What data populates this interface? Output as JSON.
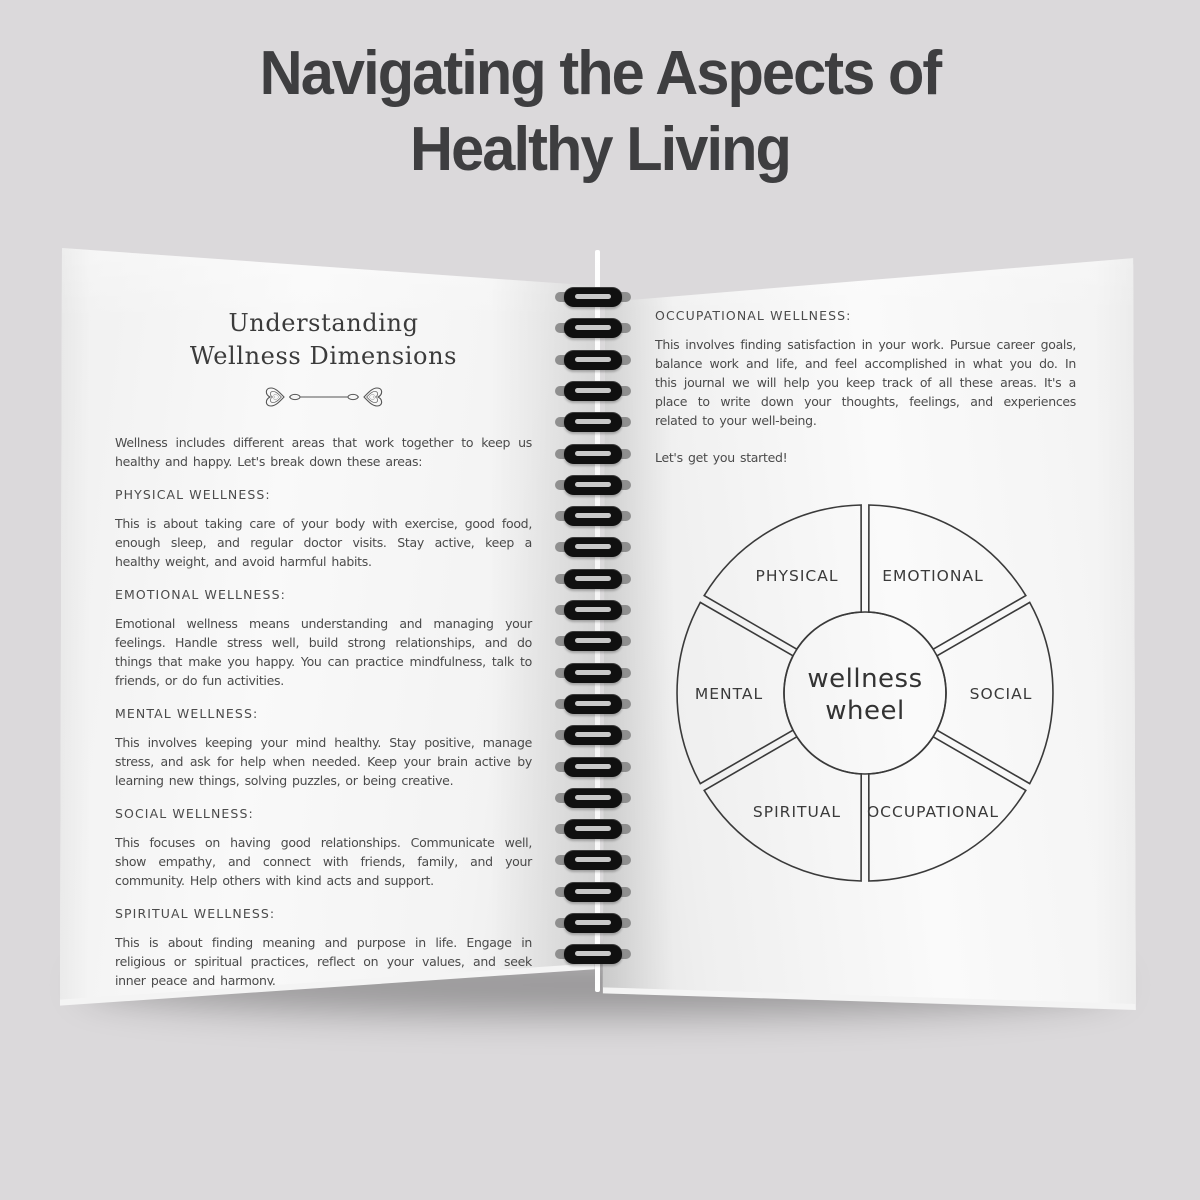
{
  "title": {
    "line1": "Navigating the Aspects of",
    "line2": "Healthy Living"
  },
  "left_page": {
    "heading_line1": "Understanding",
    "heading_line2": "Wellness Dimensions",
    "intro": "Wellness includes different areas that work together to keep us healthy and happy. Let's break down these areas:",
    "sections": [
      {
        "label": "PHYSICAL WELLNESS:",
        "body": "This is about taking care of your body with exercise, good food, enough sleep, and regular doctor visits. Stay active, keep a healthy weight, and avoid harmful habits."
      },
      {
        "label": "EMOTIONAL WELLNESS:",
        "body": "Emotional wellness means understanding and managing your feelings. Handle stress well, build strong relationships, and do things that make you happy. You can practice mindfulness, talk to friends, or do fun activities."
      },
      {
        "label": "MENTAL WELLNESS:",
        "body": "This involves keeping your mind healthy. Stay positive, manage stress, and ask for help when needed. Keep your brain active by learning new things, solving puzzles, or being creative."
      },
      {
        "label": "SOCIAL WELLNESS:",
        "body": "This focuses on having good relationships. Communicate well, show empathy, and connect with friends, family, and your community. Help others with kind acts and support."
      },
      {
        "label": "SPIRITUAL WELLNESS:",
        "body": "This is about finding meaning and purpose in life. Engage in religious or spiritual practices, reflect on your values, and seek inner peace and harmony."
      }
    ]
  },
  "right_page": {
    "section": {
      "label": "OCCUPATIONAL WELLNESS:",
      "body": "This involves finding satisfaction in your work. Pursue career goals, balance work and life, and feel accomplished in what you do. In this journal we will help you keep track of all these areas. It's a place to write down your thoughts, feelings, and experiences related to your well-being."
    },
    "callout": "Let's get you started!",
    "wheel": {
      "center_line1": "wellness",
      "center_line2": "wheel",
      "segments": [
        {
          "label": "PHYSICAL",
          "angle": -30
        },
        {
          "label": "EMOTIONAL",
          "angle": 30
        },
        {
          "label": "SOCIAL",
          "angle": 90
        },
        {
          "label": "OCCUPATIONAL",
          "angle": 150
        },
        {
          "label": "SPIRITUAL",
          "angle": 210
        },
        {
          "label": "MENTAL",
          "angle": 270
        }
      ]
    }
  },
  "colors": {
    "background": "#dbd9db",
    "title_ink": "#3e3e40",
    "body_ink": "#4b4b4b",
    "wheel_stroke": "#3a3a3a",
    "page": "#f7f7f7",
    "coil": "#101010"
  }
}
